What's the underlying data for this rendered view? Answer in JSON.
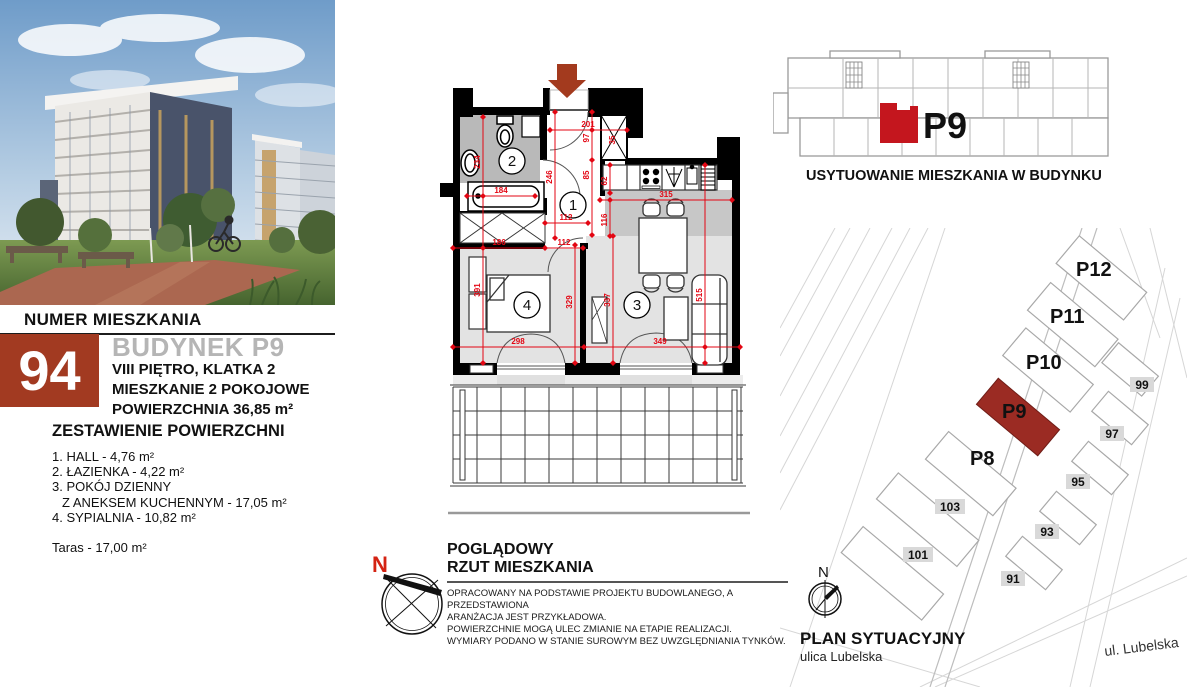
{
  "listing": {
    "header": "NUMER MIESZKANIA",
    "number": "94",
    "building": "BUDYNEK P9",
    "floor_line": "VIII PIĘTRO, KLATKA 2",
    "type_line": "MIESZKANIE 2 POKOJOWE",
    "area_line": "POWIERZCHNIA 36,85 m²",
    "areas_title": "ZESTAWIENIE POWIERZCHNI",
    "areas": [
      "1. HALL - 4,76 m²",
      "2. ŁAZIENKA - 4,22 m²",
      "3. POKÓJ DZIENNY",
      "Z ANEKSEM KUCHENNYM - 17,05 m²",
      "4. SYPIALNIA - 10,82 m²"
    ],
    "terrace": "Taras - 17,00 m²"
  },
  "plan": {
    "rooms": {
      "hall": "1",
      "bath": "2",
      "living": "3",
      "bed": "4"
    },
    "dims": {
      "w201": "201",
      "h97": "97",
      "h85": "85",
      "h246": "246",
      "w112a": "112",
      "w186": "186",
      "w112b": "112",
      "w184": "184",
      "h234": "234",
      "h391": "391",
      "w298": "298",
      "w349": "349",
      "h329": "329",
      "h337": "337",
      "h515": "515",
      "w315": "315",
      "h116": "116",
      "h62": "62",
      "h35": "35"
    },
    "compass_n": "N"
  },
  "legend": {
    "title1": "POGLĄDOWY",
    "title2": "RZUT MIESZKANIA",
    "note1": "OPRACOWANY NA PODSTAWIE PROJEKTU BUDOWLANEGO, A PRZEDSTAWIONA",
    "note2": "ARANŻACJA JEST PRZYKŁADOWA.",
    "note3": "POWIERZCHNIE MOGĄ ULEC ZMIANIE NA ETAPIE REALIZACJI.",
    "note4": "WYMIARY PODANO W STANIE SUROWYM BEZ UWZGLĘDNIANIA TYNKÓW."
  },
  "locator": {
    "label": "P9",
    "caption": "USYTUOWANIE MIESZKANIA W BUDYNKU"
  },
  "siteplan": {
    "caption": "PLAN SYTUACYJNY",
    "street": "ulica Lubelska",
    "street2": "ul. Lubelska",
    "compass_n": "N",
    "buildings": {
      "p8": "P8",
      "p9": "P9",
      "p10": "P10",
      "p11": "P11",
      "p12": "P12"
    },
    "numbers": {
      "n91": "91",
      "n93": "93",
      "n95": "95",
      "n97": "97",
      "n99": "99",
      "n101": "101",
      "n103": "103"
    }
  },
  "colors": {
    "dim_red": "#e30613",
    "brick_red": "#a23a21",
    "locator_unit_red": "#c4161e",
    "siteplan_building_red": "#9b2b23"
  }
}
